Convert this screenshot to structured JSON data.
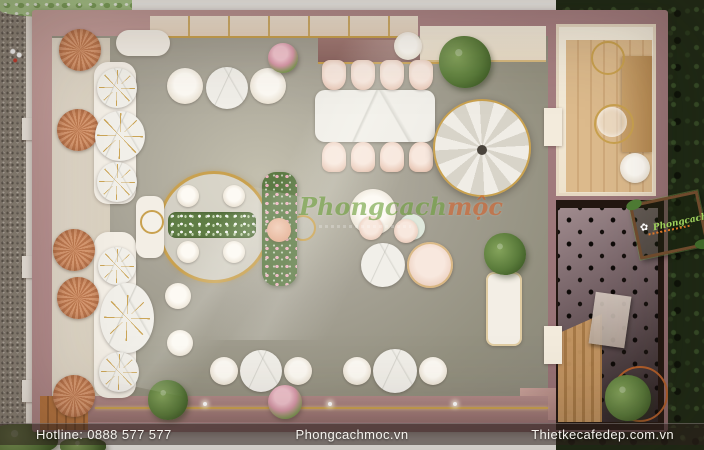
{
  "footer": {
    "hotline": "Hotline: 0888 577 577",
    "site_center": "Phongcachmoc.vn",
    "site_right": "Thietkecafedep.com.vn"
  },
  "watermark": {
    "brand_green": "Phongcach",
    "brand_orange": "mộc"
  },
  "corner_logo": {
    "brand_green": "Phongcach",
    "brand_orange": "mộc",
    "flower_icon": "✿"
  },
  "colors": {
    "wall": "#ab8385",
    "wall_light": "#c8a29e",
    "floor_mid": "#a6a295",
    "gold": "#c9a14f",
    "cream": "#f1ead9",
    "marble": "#f1efe9",
    "coral": "#d89a72",
    "coral_dark": "#bd7950",
    "hedge_dark": "#1b2913",
    "foliage_light": "#a9c98b",
    "gravel": "#8e867a",
    "wood_light": "#dcba8c",
    "wood_plank": "#b5743f",
    "peg_wall": "#736064",
    "dark_room": "#231711",
    "footer_bar": "rgba(44,31,27,0.55)",
    "footer_text": "#f6f3ee",
    "watermark_green": "#6da03c",
    "watermark_orange": "#d4632e",
    "blush": "#eccfbf",
    "mint": "#dfe8dc"
  }
}
